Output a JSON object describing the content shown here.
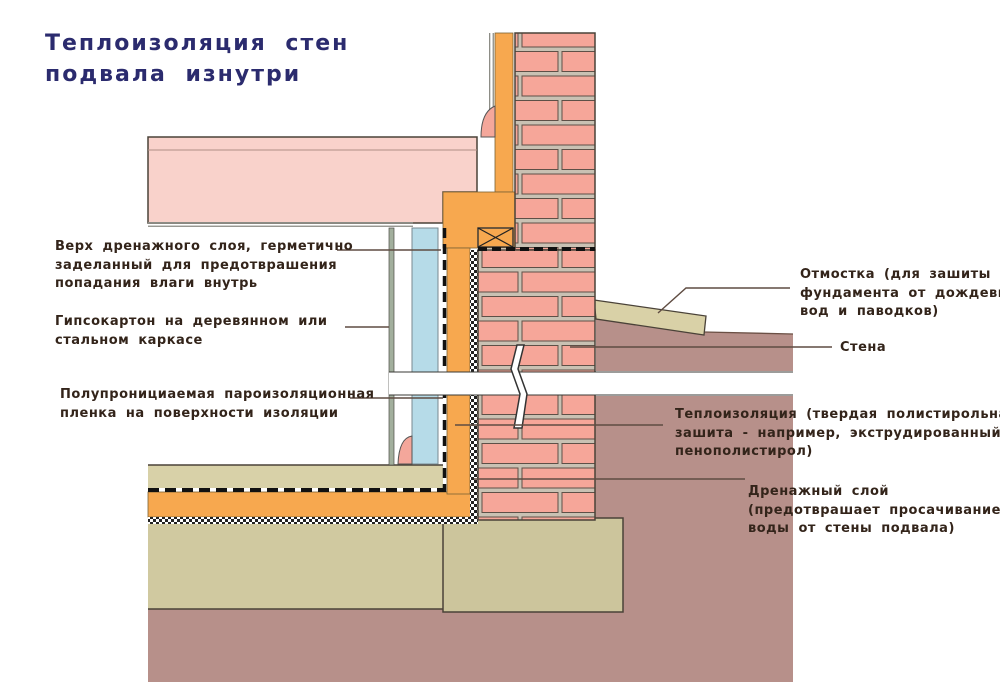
{
  "title": {
    "lines": [
      "Теплоизоляция стен",
      "подвала изнутри"
    ]
  },
  "annotations": {
    "left": [
      {
        "name": "drainage-top-seal",
        "lines": [
          "Верх дренажного слоя, герметично",
          "заделанный для предотврашения",
          "попадания влаги внутрь"
        ]
      },
      {
        "name": "gypsum-board",
        "lines": [
          "Гипсокартон на деревянном или",
          "стальном каркасе"
        ]
      },
      {
        "name": "vapor-film",
        "lines": [
          "Полупронициаемая пароизоляционная",
          "пленка на поверхности изоляции"
        ]
      }
    ],
    "right": [
      {
        "name": "blind-area",
        "lines": [
          "Отмостка (для зашиты",
          "фундамента от дождевых",
          "вод и паводков)"
        ]
      },
      {
        "name": "wall",
        "lines": [
          "Стена"
        ]
      },
      {
        "name": "thermal-insulation",
        "lines": [
          "Теплоизоляция (твердая полистирольная",
          "зашита - например, экструдированный",
          "пенополистирол)"
        ]
      },
      {
        "name": "drainage-layer",
        "lines": [
          "Дренажный слой",
          "(предотврашает просачивание",
          "воды от стены подвала)"
        ]
      }
    ]
  },
  "colors": {
    "title_text": "#2b2b6e",
    "label_text": "#33241a",
    "brick": "#f6a699",
    "mortar": "#c9c1b3",
    "slab_pink": "#f9d2cb",
    "insulation_orange": "#f7a84f",
    "drywall_blue": "#b6dbe8",
    "drywall_strip_green": "#a2af9d",
    "soil_brown": "#b7908a",
    "screed_khaki": "#d8d1a8",
    "footing_khaki": "#ccc59c",
    "blind_area_khaki": "#d9d1a7",
    "outline_dark": "#4a4238"
  }
}
